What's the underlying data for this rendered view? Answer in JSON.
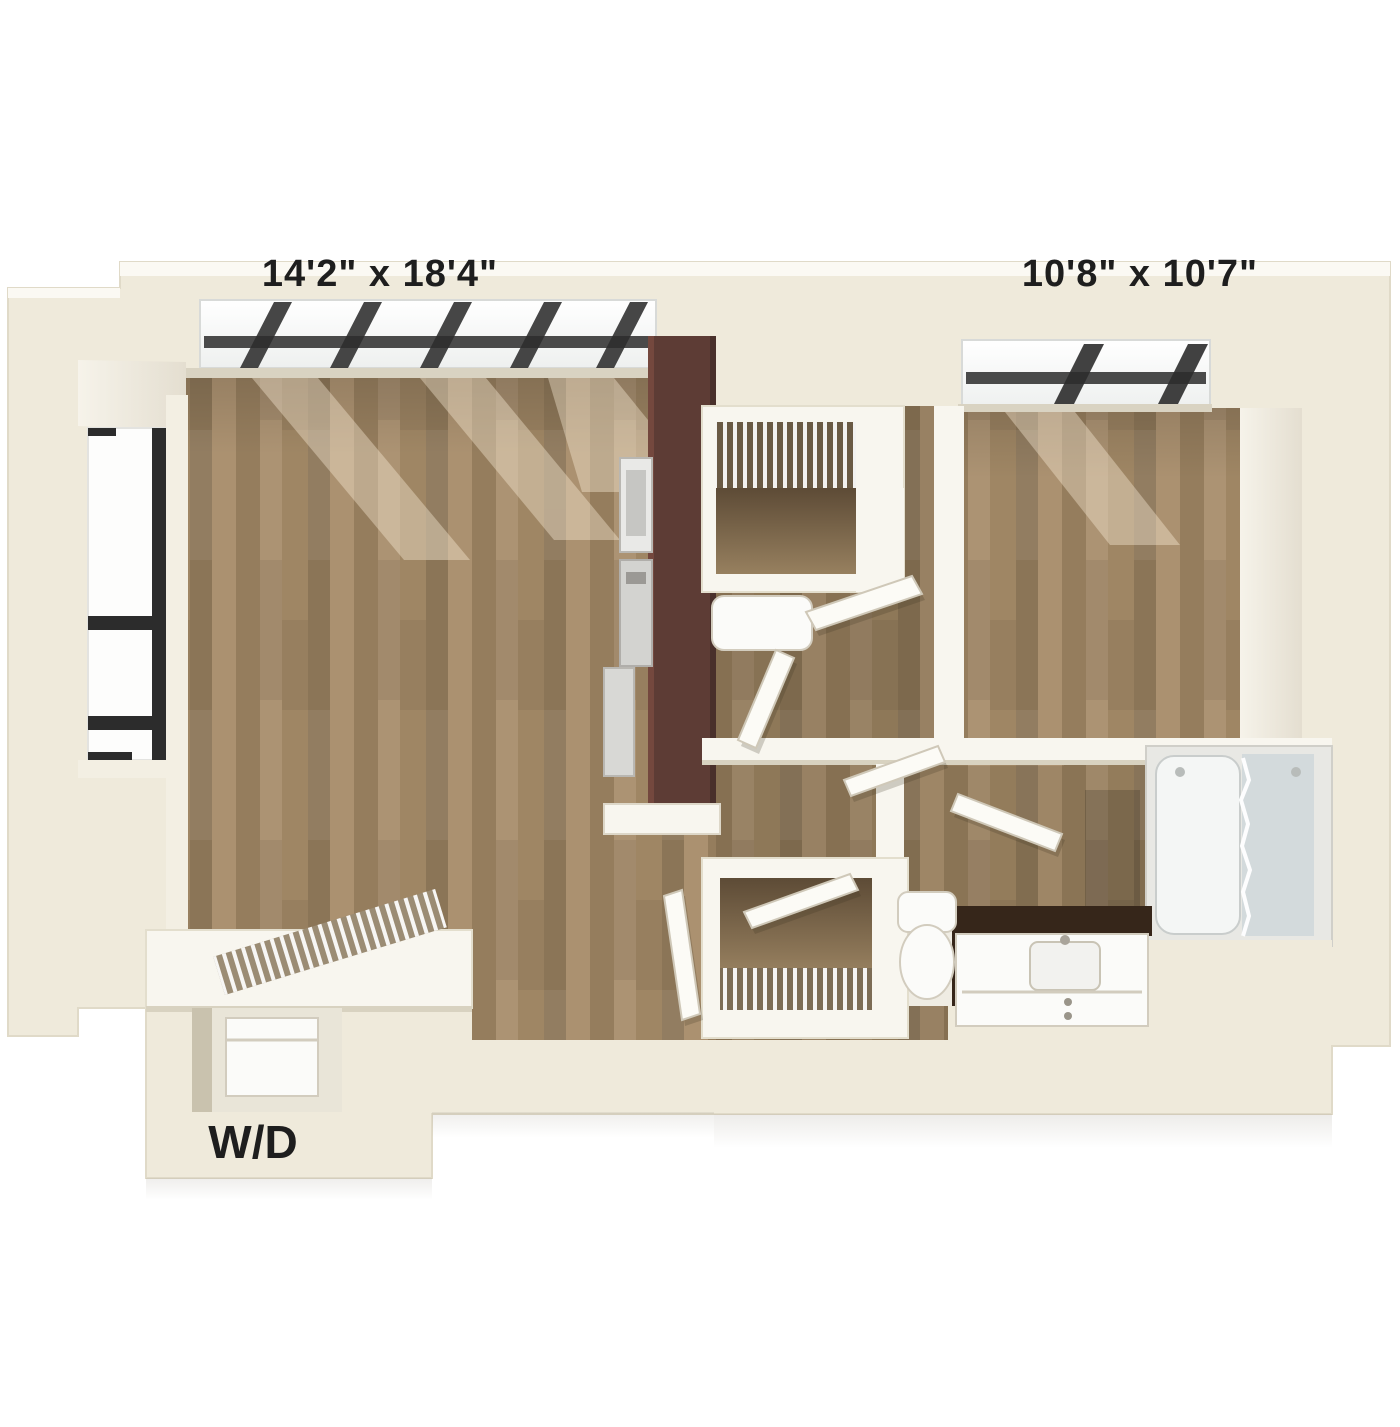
{
  "figure": {
    "kind": "3d-floor-plan-rendering",
    "rooms": {
      "living_room": {
        "dimensions": "14'2\" x 18'4\""
      },
      "bedroom": {
        "dimensions": "10'8\" x 10'7\""
      },
      "laundry": {
        "label": "W/D"
      }
    }
  },
  "colors": {
    "background": "#ffffff",
    "wall_cream": "#efeadb",
    "wall_cream_dark": "#ddd6c3",
    "wall_white": "#f8f6ef",
    "wall_shadow": "#c3bca7",
    "floor_wood": "#a68b68",
    "floor_wood_dark": "#8f7454",
    "floor_wood_deep": "#6f5a40",
    "floor_tile": "#efece3",
    "kitchen_brown": "#5d3c35",
    "kitchen_brown_dark": "#49302b",
    "appliance_gray": "#c9c9c7",
    "window_white": "#fdfdfc",
    "window_frame": "#2c2c2c",
    "glass_blue": "#ccd5d9",
    "counter_dark": "#36261a",
    "fixture_white": "#fbfbf9",
    "shaft_light": "#fff3dd",
    "label_color": "#1e1e1e"
  }
}
